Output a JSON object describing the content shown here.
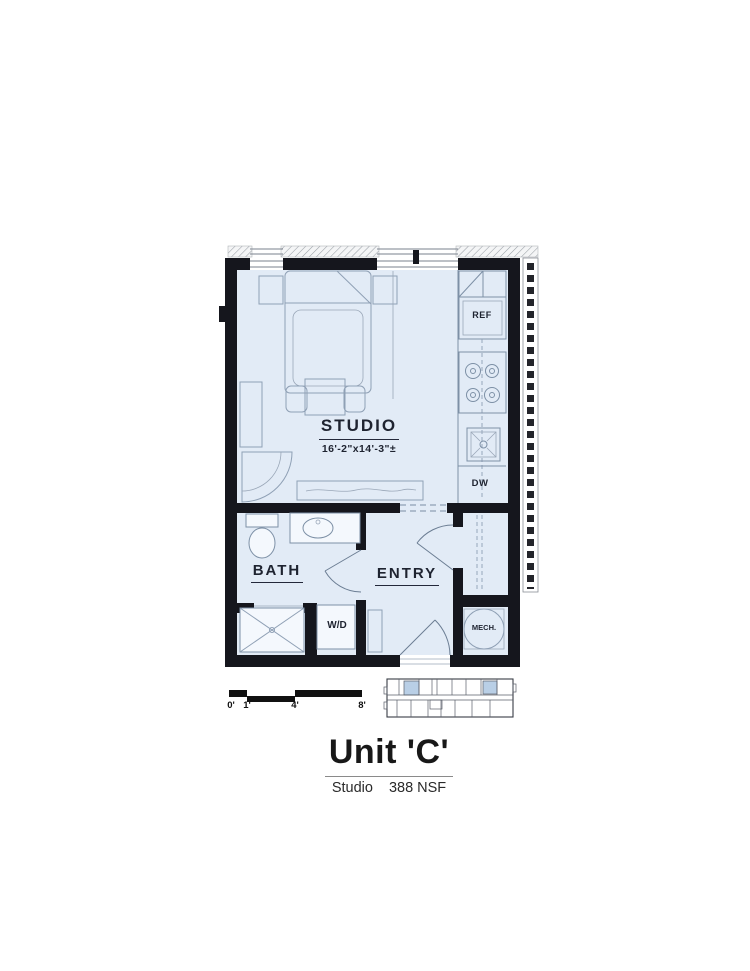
{
  "plan": {
    "studio": {
      "name": "STUDIO",
      "dimensions": "16'-2\"x14'-3\"±"
    },
    "bath": {
      "name": "BATH"
    },
    "entry": {
      "name": "ENTRY"
    },
    "fixture_labels": {
      "ref": "REF",
      "dw": "DW",
      "wd": "W/D",
      "mech": "MECH."
    }
  },
  "scale_bar": {
    "ticks": [
      "0'",
      "1'",
      "4'",
      "8'"
    ]
  },
  "title_block": {
    "title": "Unit 'C'",
    "unit_type": "Studio",
    "area": "388 NSF"
  },
  "colors": {
    "floor_fill": "#e2ebf6",
    "wall": "#15161d",
    "furniture_line": "#8fa0b5",
    "text": "#1e2330",
    "keyplan_highlight": "#b9cfe6",
    "hatch": "#9aa0a6"
  }
}
